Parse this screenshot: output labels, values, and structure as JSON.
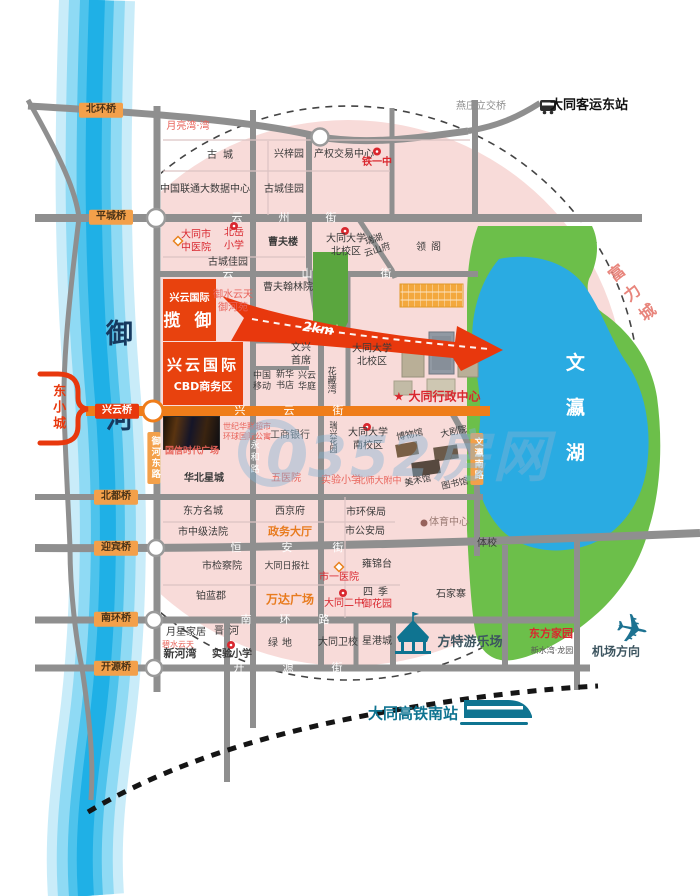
{
  "watermark": {
    "text": "0352房网"
  },
  "colors": {
    "project_red": "#e8380d",
    "road_gray": "#8f8f8f",
    "street_orange": "#ef7d1a",
    "bridge_badge_orange": "#f3a04a",
    "river_blue": "#1fb0e6",
    "lake_blue": "#2aabe2",
    "park_green": "#6cbf4a",
    "zone_pink": "#f8dbd9",
    "poi_red": "#d9272e",
    "teal": "#0f7491"
  },
  "icons": {
    "plane_glyph": "✈",
    "names": [
      "bus-icon",
      "train-icon",
      "plane-icon",
      "carousel-icon",
      "school-icon",
      "hospital-icon",
      "sports-icon",
      "watermark-ring-icon"
    ]
  },
  "projects": {
    "lanyu": {
      "line1": "兴云国际",
      "line2": "揽 御"
    },
    "cbd": {
      "line1": "兴云国际",
      "line2": "CBD商务区"
    }
  },
  "bridges": [
    {
      "name": "bridge-beihuan",
      "text": "北环桥",
      "x": 101,
      "y": 110,
      "cls": "badge"
    },
    {
      "name": "bridge-pingcheng",
      "text": "平城桥",
      "x": 111,
      "y": 217,
      "cls": "badge"
    },
    {
      "name": "bridge-xingyun",
      "text": "兴云桥",
      "x": 117,
      "y": 411,
      "cls": "badge redv"
    },
    {
      "name": "bridge-beidu",
      "text": "北都桥",
      "x": 116,
      "y": 497,
      "cls": "badge"
    },
    {
      "name": "bridge-yingbin",
      "text": "迎宾桥",
      "x": 116,
      "y": 548,
      "cls": "badge"
    },
    {
      "name": "bridge-nanhuan",
      "text": "南环桥",
      "x": 116,
      "y": 619,
      "cls": "badge"
    },
    {
      "name": "bridge-kaiyuan",
      "text": "开源桥",
      "x": 116,
      "y": 668,
      "cls": "badge"
    }
  ],
  "streets": [
    {
      "name": "street-yunzhou",
      "text": "云州街",
      "x": 302,
      "y": 218,
      "ls": 36,
      "cls": "street"
    },
    {
      "name": "street-yunshan",
      "text": "云山街",
      "x": 341,
      "y": 274,
      "ls": 68,
      "cls": "street"
    },
    {
      "name": "street-xingyun",
      "text": "兴云街",
      "x": 308,
      "y": 411,
      "ls": 38,
      "cls": "street"
    },
    {
      "name": "street-hengan",
      "text": "恒安街",
      "x": 307,
      "y": 548,
      "ls": 40,
      "cls": "street"
    },
    {
      "name": "street-nanhuan",
      "text": "南环路",
      "x": 299,
      "y": 620,
      "ls": 28,
      "cls": "street"
    },
    {
      "name": "street-kaiyuan",
      "text": "开源街",
      "x": 307,
      "y": 668,
      "ls": 38,
      "cls": "street"
    },
    {
      "name": "road-yuhe-east",
      "text": "御河东路",
      "x": 154,
      "y": 458,
      "cls": "vbadge"
    },
    {
      "name": "road-wenying-south",
      "text": "文瀛南路",
      "x": 477,
      "y": 459,
      "cls": "vbadge"
    },
    {
      "name": "road-yonghe",
      "text": "永和路",
      "x": 253,
      "y": 458,
      "cls": "vroad"
    }
  ],
  "labels": [
    {
      "name": "yanzhuang-interchange-label",
      "text": "燕庄立交桥",
      "x": 481,
      "y": 107,
      "cls": "gray"
    },
    {
      "name": "east-bus-station-label",
      "text": "大同客运东站",
      "x": 589,
      "y": 106,
      "cls": "black bold fs13"
    },
    {
      "name": "yueliangwan-label",
      "text": "月亮湾·湾",
      "x": 188,
      "y": 127,
      "cls": "salmon"
    },
    {
      "name": "gucheng-label",
      "text": "古城",
      "x": 223,
      "y": 156,
      "ls": 6
    },
    {
      "name": "xingziyuan-label",
      "text": "兴梓园",
      "x": 289,
      "y": 155
    },
    {
      "name": "property-exchange-label",
      "text": "产权交易中心",
      "x": 344,
      "y": 155
    },
    {
      "name": "tieyizhong-label",
      "text": "铁一中",
      "x": 377,
      "y": 163,
      "cls": "red bold"
    },
    {
      "name": "unicom-datacenter-label",
      "text": "中国联通大数据中心",
      "x": 205,
      "y": 190
    },
    {
      "name": "guchengjiayuan-label",
      "text": "古城佳园",
      "x": 284,
      "y": 190
    },
    {
      "name": "city-tcm-hospital-label",
      "text": "大同市\n中医院",
      "x": 196,
      "y": 242,
      "cls": "red pre"
    },
    {
      "name": "beiyue-primary-label",
      "text": "北岳\n小学",
      "x": 234,
      "y": 240,
      "cls": "red pre"
    },
    {
      "name": "guchengjiayuan2-label",
      "text": "古城佳园",
      "x": 228,
      "y": 263
    },
    {
      "name": "caofulou-label",
      "text": "曹夫楼",
      "x": 283,
      "y": 243,
      "cls": "bold"
    },
    {
      "name": "dtu-north-campus-label",
      "text": "大同大学\n北校区",
      "x": 346,
      "y": 246,
      "cls": "pre"
    },
    {
      "name": "ruihu-yunshanfu-label",
      "text": "瑞湖\n云山府",
      "x": 376,
      "y": 246,
      "cls": "pre small tilt18"
    },
    {
      "name": "lingge-label",
      "text": "领阁",
      "x": 431,
      "y": 248,
      "ls": 5
    },
    {
      "name": "yushuiyuntian-label",
      "text": "御水云天\n御河苑",
      "x": 233,
      "y": 302,
      "cls": "salmon pre"
    },
    {
      "name": "caofuhanlin-label",
      "text": "曹夫翰林院",
      "x": 288,
      "y": 288
    },
    {
      "name": "km-label",
      "text": "2km",
      "x": 318,
      "y": 330,
      "cls": "km"
    },
    {
      "name": "wenxing-label",
      "text": "文兴\n首席",
      "x": 301,
      "y": 355,
      "cls": "pre"
    },
    {
      "name": "china-mobile-label",
      "text": "中国\n移动",
      "x": 262,
      "y": 382,
      "cls": "pre small"
    },
    {
      "name": "xinhua-bookstore-label",
      "text": "新华\n书店",
      "x": 285,
      "y": 381,
      "cls": "pre small"
    },
    {
      "name": "xingyun-huating-label",
      "text": "兴云\n华庭",
      "x": 307,
      "y": 382,
      "cls": "pre small"
    },
    {
      "name": "huacangwan-label",
      "text": "花藏湾",
      "x": 330,
      "y": 380,
      "cls": "vert small"
    },
    {
      "name": "dtu-north-campus2-label",
      "text": "大同大学\n北校区",
      "x": 372,
      "y": 356,
      "cls": "pre"
    },
    {
      "name": "admin-center-label",
      "text": "★ 大同行政中心",
      "x": 437,
      "y": 397,
      "cls": "red bold fs12"
    },
    {
      "name": "guoxin-plaza-label",
      "text": "国信时代广场",
      "x": 192,
      "y": 452,
      "cls": "salmon bold small"
    },
    {
      "name": "hualian-label",
      "text": "世纪华联超市\n环球国际公寓",
      "x": 247,
      "y": 432,
      "cls": "salmon pre tiny"
    },
    {
      "name": "icbc-label",
      "text": "工商银行",
      "x": 290,
      "y": 436,
      "cls": "dim"
    },
    {
      "name": "ruixing-garden-label",
      "text": "瑞兴花园",
      "x": 333,
      "y": 437,
      "cls": "vert tiny"
    },
    {
      "name": "dtu-south-campus-label",
      "text": "大同大学\n南校区",
      "x": 368,
      "y": 440,
      "cls": "pre"
    },
    {
      "name": "museum-label",
      "text": "博物馆",
      "x": 410,
      "y": 436,
      "cls": "small tilt12"
    },
    {
      "name": "theater-label",
      "text": "大剧院",
      "x": 454,
      "y": 433,
      "cls": "small tilt12"
    },
    {
      "name": "art-gallery-label",
      "text": "美术馆",
      "x": 418,
      "y": 482,
      "cls": "small tilt12"
    },
    {
      "name": "library-label",
      "text": "图书馆",
      "x": 455,
      "y": 485,
      "cls": "small tilt12"
    },
    {
      "name": "huabei-xingcheng-label",
      "text": "华北星城",
      "x": 204,
      "y": 479,
      "cls": "bold"
    },
    {
      "name": "fifth-hospital-label",
      "text": "五医院",
      "x": 286,
      "y": 479,
      "cls": "salmon"
    },
    {
      "name": "shiyan-primary-label",
      "text": "实验小学",
      "x": 341,
      "y": 481,
      "cls": "salmon"
    },
    {
      "name": "beishida-label",
      "text": "北师大附中",
      "x": 379,
      "y": 482,
      "cls": "salmon small"
    },
    {
      "name": "dongfang-mingcheng-label",
      "text": "东方名城",
      "x": 203,
      "y": 512
    },
    {
      "name": "xijingfu-label",
      "text": "西京府",
      "x": 290,
      "y": 512
    },
    {
      "name": "epa-label",
      "text": "市环保局",
      "x": 366,
      "y": 513
    },
    {
      "name": "court-label",
      "text": "市中级法院",
      "x": 203,
      "y": 533
    },
    {
      "name": "zhengwu-hall-label",
      "text": "政务大厅",
      "x": 290,
      "y": 532,
      "cls": "orange bold fs11"
    },
    {
      "name": "police-label",
      "text": "市公安局",
      "x": 365,
      "y": 532
    },
    {
      "name": "sports-center-label",
      "text": "体育中心",
      "x": 449,
      "y": 523,
      "cls": "muted"
    },
    {
      "name": "sports-school-label",
      "text": "体校",
      "x": 487,
      "y": 544
    },
    {
      "name": "procuratorate-label",
      "text": "市检察院",
      "x": 222,
      "y": 567
    },
    {
      "name": "daily-press-label",
      "text": "大同日报社",
      "x": 287,
      "y": 567,
      "cls": "small"
    },
    {
      "name": "first-hospital-label",
      "text": "市一医院",
      "x": 339,
      "y": 578,
      "cls": "red"
    },
    {
      "name": "yongjintai-label",
      "text": "雍锦台",
      "x": 377,
      "y": 565
    },
    {
      "name": "bolanjun-label",
      "text": "铂蓝郡",
      "x": 211,
      "y": 597
    },
    {
      "name": "wanda-plaza-label",
      "text": "万达广场",
      "x": 290,
      "y": 600,
      "cls": "orange bold fs12"
    },
    {
      "name": "no2-middle-school-label",
      "text": "大同二中",
      "x": 344,
      "y": 604,
      "cls": "red"
    },
    {
      "name": "siji-label",
      "text": "四季",
      "x": 378,
      "y": 593,
      "ls": 5
    },
    {
      "name": "yuhuayuan-label",
      "text": "御花园",
      "x": 377,
      "y": 605,
      "cls": "red"
    },
    {
      "name": "shijiazhai-label",
      "text": "石家寨",
      "x": 451,
      "y": 595
    },
    {
      "name": "yuexing-home-label",
      "text": "月星家居",
      "x": 186,
      "y": 633
    },
    {
      "name": "jinhe-label",
      "text": "晋河",
      "x": 229,
      "y": 632,
      "ls": 5
    },
    {
      "name": "bishuiyuntian-label",
      "text": "碧水云天",
      "x": 178,
      "y": 645,
      "cls": "salmon tiny"
    },
    {
      "name": "xinhewan-label",
      "text": "新河湾",
      "x": 180,
      "y": 654,
      "cls": "bold fs11"
    },
    {
      "name": "shiyan-primary2-label",
      "text": "实验小学",
      "x": 232,
      "y": 655,
      "cls": "bold"
    },
    {
      "name": "lvdi-label",
      "text": "绿地",
      "x": 282,
      "y": 644,
      "ls": 4
    },
    {
      "name": "health-school-label",
      "text": "大同卫校",
      "x": 338,
      "y": 643
    },
    {
      "name": "xinggangcheng-label",
      "text": "星港城",
      "x": 377,
      "y": 642
    },
    {
      "name": "fangte-park-label",
      "text": "方特游乐场",
      "x": 470,
      "y": 643,
      "cls": "slate bold fs13"
    },
    {
      "name": "dongfang-jiayuan-label",
      "text": "东方家园",
      "x": 551,
      "y": 634,
      "cls": "red bold fs11"
    },
    {
      "name": "xinshuiwan-label",
      "text": "新水湾·龙园",
      "x": 552,
      "y": 651,
      "cls": "tiny dim"
    },
    {
      "name": "airport-direction-label",
      "text": "机场方向",
      "x": 616,
      "y": 652,
      "cls": "slate bold fs12"
    },
    {
      "name": "hsr-south-station-label",
      "text": "大同高铁南站",
      "x": 413,
      "y": 714,
      "cls": "teal bold fs15"
    },
    {
      "name": "fulicheng-label",
      "text": "富力城",
      "x": 633,
      "y": 297,
      "cls": "fuli"
    },
    {
      "name": "wenyinghu-lake-label",
      "text": "文瀛湖",
      "x": 573,
      "y": 420,
      "cls": "lakename"
    },
    {
      "name": "yuhe-river-label",
      "text": "御河",
      "x": 116,
      "y": 404,
      "cls": "rivername"
    },
    {
      "name": "dongxiaocheng-label",
      "text": "东小城",
      "x": 57,
      "y": 408,
      "cls": "dxc"
    }
  ]
}
